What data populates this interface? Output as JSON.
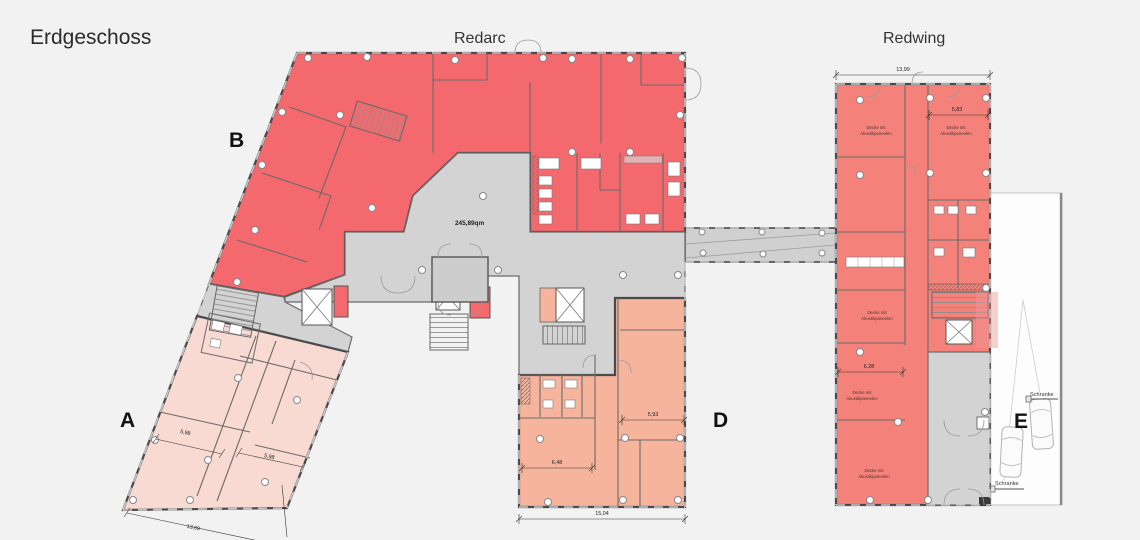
{
  "title": "Erdgeschoss",
  "buildings": {
    "left_name": "Redarc",
    "right_name": "Redwing"
  },
  "sections": {
    "a": "A",
    "b": "B",
    "d": "D",
    "e": "E"
  },
  "hall": {
    "area": "245,89qm"
  },
  "rooms": {
    "acoustic_line1": "Decke mit",
    "acoustic_line2": "Akustikpaneelen"
  },
  "parking": {
    "barrier": "Schranke"
  },
  "dimensions": {
    "redwing_width": "13,99",
    "redwing_room_top": "5,83",
    "redwing_room_mid": "6,28",
    "d_width": "15,04",
    "d_room_left": "6,48",
    "d_room_right": "5,93",
    "a_room_upper": "5,98",
    "a_room_lower": "5,98",
    "a_bottom": "13,69"
  },
  "colors": {
    "redarc_red": "#f4696d",
    "redwing_red": "#f5827a",
    "section_a_pink": "#f9dad2",
    "section_d_orange": "#f6b49d",
    "hall_gray": "#d3d3d3",
    "wall": "#4a4a4a",
    "background": "#f2f2f2",
    "parking_white": "#fdfdfd"
  }
}
